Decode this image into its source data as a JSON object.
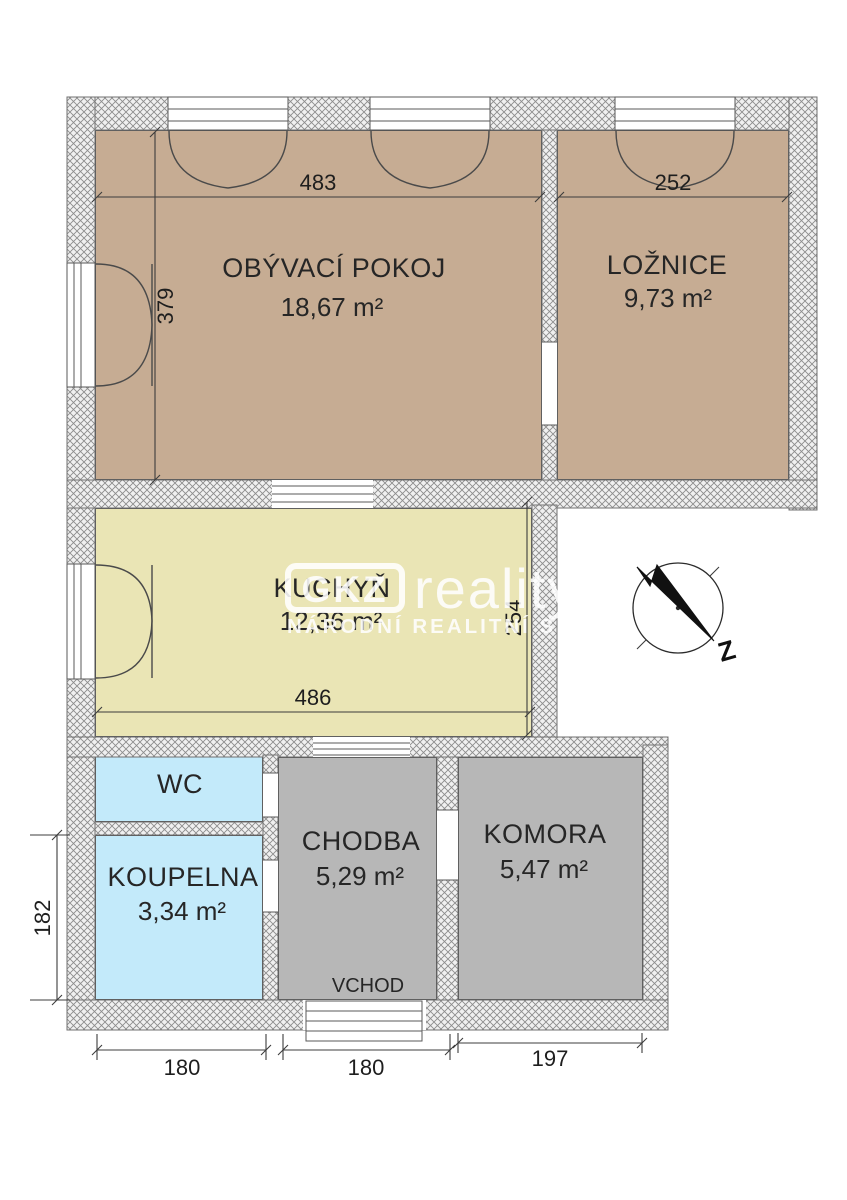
{
  "plan_title": "Floor plan",
  "rooms": [
    {
      "id": "living-room",
      "name": "OBÝVACÍ POKOJ",
      "area": "18,67 m²",
      "color": "#c6ac93"
    },
    {
      "id": "bedroom",
      "name": "LOŽNICE",
      "area": "9,73 m²",
      "color": "#c6ac93"
    },
    {
      "id": "kitchen",
      "name": "KUCHYŇ",
      "area": "12,36 m²",
      "color": "#eae5b5"
    },
    {
      "id": "wc",
      "name": "WC",
      "area": "",
      "color": "#c3eafa"
    },
    {
      "id": "bathroom",
      "name": "KOUPELNA",
      "area": "3,34 m²",
      "color": "#c3eafa"
    },
    {
      "id": "hallway",
      "name": "CHODBA",
      "area": "5,29 m²",
      "color": "#b7b7b7"
    },
    {
      "id": "storage",
      "name": "KOMORA",
      "area": "5,47 m²",
      "color": "#b7b7b7"
    }
  ],
  "labels": {
    "entrance": "VCHOD"
  },
  "dimensions": {
    "living_width": "483",
    "living_height": "379",
    "bedroom_width": "252",
    "kitchen_width": "486",
    "kitchen_height": "254",
    "bathroom_height": "182",
    "bathroom_width": "180",
    "hallway_width": "180",
    "storage_width": "197"
  },
  "watermark": {
    "logo": "GKZ",
    "brand": "reality",
    "tagline": "NÁRODNÍ REALITNÍ SLUŽBY"
  },
  "compass": {
    "label": "Z"
  },
  "colors": {
    "wall_hatch": "#8c8c8c",
    "floor_outline": "#4f4f4f",
    "dim_line": "#3c3c3c"
  }
}
